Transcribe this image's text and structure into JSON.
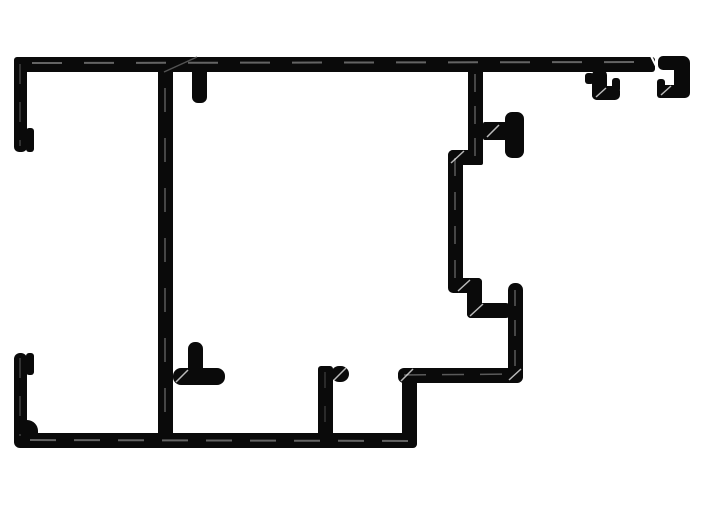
{
  "canvas": {
    "width": 702,
    "height": 525,
    "background": "#ffffff",
    "ink": "#0a0a0a",
    "highlight": "#6e6e6e",
    "hatch": "#f5f5f5"
  },
  "drawing": {
    "description": "aluminium-extrusion-profile-cross-section",
    "rects": [
      {
        "name": "top-flange-bar",
        "x": 14,
        "y": 57,
        "w": 641,
        "h": 15,
        "rx": 3
      },
      {
        "name": "top-left-outer-wall",
        "x": 14,
        "y": 57,
        "w": 13,
        "h": 95,
        "rx": 5
      },
      {
        "name": "top-left-inner-foot",
        "x": 26,
        "y": 128,
        "w": 8,
        "h": 24,
        "rx": 3
      },
      {
        "name": "main-center-web",
        "x": 158,
        "y": 60,
        "w": 15,
        "h": 388,
        "rx": 2
      },
      {
        "name": "top-inner-stub",
        "x": 192,
        "y": 64,
        "w": 15,
        "h": 39,
        "rx": 6
      },
      {
        "name": "right-upper-web",
        "x": 468,
        "y": 60,
        "w": 15,
        "h": 105,
        "rx": 2
      },
      {
        "name": "upper-step-shelf",
        "x": 448,
        "y": 150,
        "w": 30,
        "h": 15,
        "rx": 5
      },
      {
        "name": "right-mid-web",
        "x": 448,
        "y": 150,
        "w": 15,
        "h": 143,
        "rx": 5
      },
      {
        "name": "screw-boss-stem",
        "x": 483,
        "y": 122,
        "w": 25,
        "h": 18,
        "rx": 2
      },
      {
        "name": "screw-boss-cap",
        "x": 505,
        "y": 112,
        "w": 19,
        "h": 46,
        "rx": 7
      },
      {
        "name": "lower-step-shelf-1",
        "x": 455,
        "y": 278,
        "w": 27,
        "h": 15,
        "rx": 4
      },
      {
        "name": "lower-step-web",
        "x": 467,
        "y": 278,
        "w": 15,
        "h": 40,
        "rx": 4
      },
      {
        "name": "lower-step-shelf-2",
        "x": 467,
        "y": 303,
        "w": 43,
        "h": 15,
        "rx": 4
      },
      {
        "name": "right-lower-web",
        "x": 508,
        "y": 283,
        "w": 15,
        "h": 100,
        "rx": 7
      },
      {
        "name": "lower-right-arm",
        "x": 398,
        "y": 368,
        "w": 125,
        "h": 15,
        "rx": 6
      },
      {
        "name": "lower-right-wall",
        "x": 402,
        "y": 368,
        "w": 15,
        "h": 79,
        "rx": 4
      },
      {
        "name": "bottom-flange-bar",
        "x": 18,
        "y": 433,
        "w": 399,
        "h": 15,
        "rx": 4
      },
      {
        "name": "bottom-left-outer-wall",
        "x": 14,
        "y": 353,
        "w": 13,
        "h": 95,
        "rx": 6
      },
      {
        "name": "bottom-left-corner-fillet",
        "x": 14,
        "y": 420,
        "w": 24,
        "h": 28,
        "rx": 11
      },
      {
        "name": "bottom-left-inner-lip",
        "x": 26,
        "y": 353,
        "w": 8,
        "h": 22,
        "rx": 3
      },
      {
        "name": "bottom-tee-arm",
        "x": 173,
        "y": 368,
        "w": 52,
        "h": 17,
        "rx": 8
      },
      {
        "name": "bottom-tee-finger",
        "x": 188,
        "y": 342,
        "w": 15,
        "h": 43,
        "rx": 7
      },
      {
        "name": "bottom-mid-wall",
        "x": 318,
        "y": 366,
        "w": 15,
        "h": 82,
        "rx": 3
      },
      {
        "name": "bottom-mid-stub",
        "x": 331,
        "y": 366,
        "w": 18,
        "h": 16,
        "rx": 8
      },
      {
        "name": "gasket-hook-stem",
        "x": 592,
        "y": 70,
        "w": 15,
        "h": 30,
        "rx": 5
      },
      {
        "name": "gasket-hook-nub",
        "x": 585,
        "y": 73,
        "w": 9,
        "h": 11,
        "rx": 3
      },
      {
        "name": "gasket-hook-curl",
        "x": 592,
        "y": 86,
        "w": 28,
        "h": 14,
        "rx": 5
      },
      {
        "name": "gasket-hook-tip",
        "x": 612,
        "y": 78,
        "w": 8,
        "h": 14,
        "rx": 3
      },
      {
        "name": "end-hook-top",
        "x": 658,
        "y": 56,
        "w": 28,
        "h": 14,
        "rx": 5
      },
      {
        "name": "end-hook-wall",
        "x": 674,
        "y": 56,
        "w": 16,
        "h": 42,
        "rx": 7
      },
      {
        "name": "end-hook-bottom",
        "x": 657,
        "y": 85,
        "w": 33,
        "h": 13,
        "rx": 5
      },
      {
        "name": "end-hook-tip",
        "x": 657,
        "y": 79,
        "w": 8,
        "h": 19,
        "rx": 3
      }
    ],
    "lines": [
      {
        "name": "top-bar-centerline",
        "x1": 32,
        "y1": 63,
        "x2": 648,
        "y2": 62,
        "color": "#6e6e6e",
        "w": 2,
        "dash": "30 22",
        "op": 0.9
      },
      {
        "name": "top-bar-break-diagonal",
        "x1": 164,
        "y1": 72,
        "x2": 197,
        "y2": 57,
        "color": "#5a5a5a",
        "w": 1.5,
        "dash": "",
        "op": 0.9
      },
      {
        "name": "center-web-centerline",
        "x1": 165,
        "y1": 88,
        "x2": 165,
        "y2": 428,
        "color": "#6e6e6e",
        "w": 1.5,
        "dash": "24 26",
        "op": 0.8
      },
      {
        "name": "right-upper-centerline",
        "x1": 475,
        "y1": 74,
        "x2": 475,
        "y2": 160,
        "color": "#6e6e6e",
        "w": 1.5,
        "dash": "18 14",
        "op": 0.8
      },
      {
        "name": "right-mid-centerline",
        "x1": 455,
        "y1": 158,
        "x2": 455,
        "y2": 286,
        "color": "#6e6e6e",
        "w": 1.5,
        "dash": "18 16",
        "op": 0.8
      },
      {
        "name": "right-lower-centerline",
        "x1": 515,
        "y1": 290,
        "x2": 515,
        "y2": 376,
        "color": "#6e6e6e",
        "w": 1.5,
        "dash": "16 14",
        "op": 0.8
      },
      {
        "name": "arm-centerline",
        "x1": 404,
        "y1": 375,
        "x2": 516,
        "y2": 374,
        "color": "#6e6e6e",
        "w": 1.5,
        "dash": "22 16",
        "op": 0.8
      },
      {
        "name": "bottom-bar-centerline",
        "x1": 30,
        "y1": 440,
        "x2": 410,
        "y2": 441,
        "color": "#6e6e6e",
        "w": 2,
        "dash": "26 18",
        "op": 0.9
      },
      {
        "name": "top-left-centerline",
        "x1": 20,
        "y1": 64,
        "x2": 20,
        "y2": 146,
        "color": "#555555",
        "w": 1.5,
        "dash": "20 18",
        "op": 0.7
      },
      {
        "name": "bottom-left-centerline",
        "x1": 20,
        "y1": 358,
        "x2": 20,
        "y2": 436,
        "color": "#555555",
        "w": 1.5,
        "dash": "20 18",
        "op": 0.7
      },
      {
        "name": "bottom-mid-centerline",
        "x1": 325,
        "y1": 372,
        "x2": 325,
        "y2": 440,
        "color": "#555555",
        "w": 1.2,
        "dash": "16 18",
        "op": 0.7
      },
      {
        "name": "hatch-upper-step",
        "x1": 451,
        "y1": 163,
        "x2": 464,
        "y2": 151,
        "color": "#f5f5f5",
        "w": 1.5,
        "dash": "",
        "op": 0.75
      },
      {
        "name": "hatch-lower-step-1",
        "x1": 458,
        "y1": 291,
        "x2": 470,
        "y2": 280,
        "color": "#f5f5f5",
        "w": 1.5,
        "dash": "",
        "op": 0.75
      },
      {
        "name": "hatch-lower-step-2",
        "x1": 470,
        "y1": 316,
        "x2": 483,
        "y2": 304,
        "color": "#f5f5f5",
        "w": 1.5,
        "dash": "",
        "op": 0.75
      },
      {
        "name": "hatch-arm-left-corner",
        "x1": 401,
        "y1": 381,
        "x2": 413,
        "y2": 369,
        "color": "#f5f5f5",
        "w": 1.5,
        "dash": "",
        "op": 0.75
      },
      {
        "name": "hatch-arm-right-corner",
        "x1": 509,
        "y1": 380,
        "x2": 521,
        "y2": 369,
        "color": "#f5f5f5",
        "w": 1.5,
        "dash": "",
        "op": 0.75
      },
      {
        "name": "hatch-bottom-tee",
        "x1": 176,
        "y1": 382,
        "x2": 188,
        "y2": 370,
        "color": "#f5f5f5",
        "w": 1.5,
        "dash": "",
        "op": 0.75
      },
      {
        "name": "hatch-bottom-mid-stub",
        "x1": 334,
        "y1": 380,
        "x2": 346,
        "y2": 368,
        "color": "#f5f5f5",
        "w": 1.5,
        "dash": "",
        "op": 0.75
      },
      {
        "name": "hatch-screw-boss",
        "x1": 487,
        "y1": 137,
        "x2": 499,
        "y2": 125,
        "color": "#f5f5f5",
        "w": 1.5,
        "dash": "",
        "op": 0.75
      },
      {
        "name": "hatch-gasket-hook",
        "x1": 596,
        "y1": 97,
        "x2": 606,
        "y2": 88,
        "color": "#f5f5f5",
        "w": 1.5,
        "dash": "",
        "op": 0.75
      },
      {
        "name": "hatch-end-hook",
        "x1": 661,
        "y1": 95,
        "x2": 671,
        "y2": 86,
        "color": "#f5f5f5",
        "w": 1.5,
        "dash": "",
        "op": 0.75
      },
      {
        "name": "end-hook-break-slash",
        "x1": 651,
        "y1": 56,
        "x2": 659,
        "y2": 72,
        "color": "#ffffff",
        "w": 2,
        "dash": "",
        "op": 1
      }
    ]
  }
}
